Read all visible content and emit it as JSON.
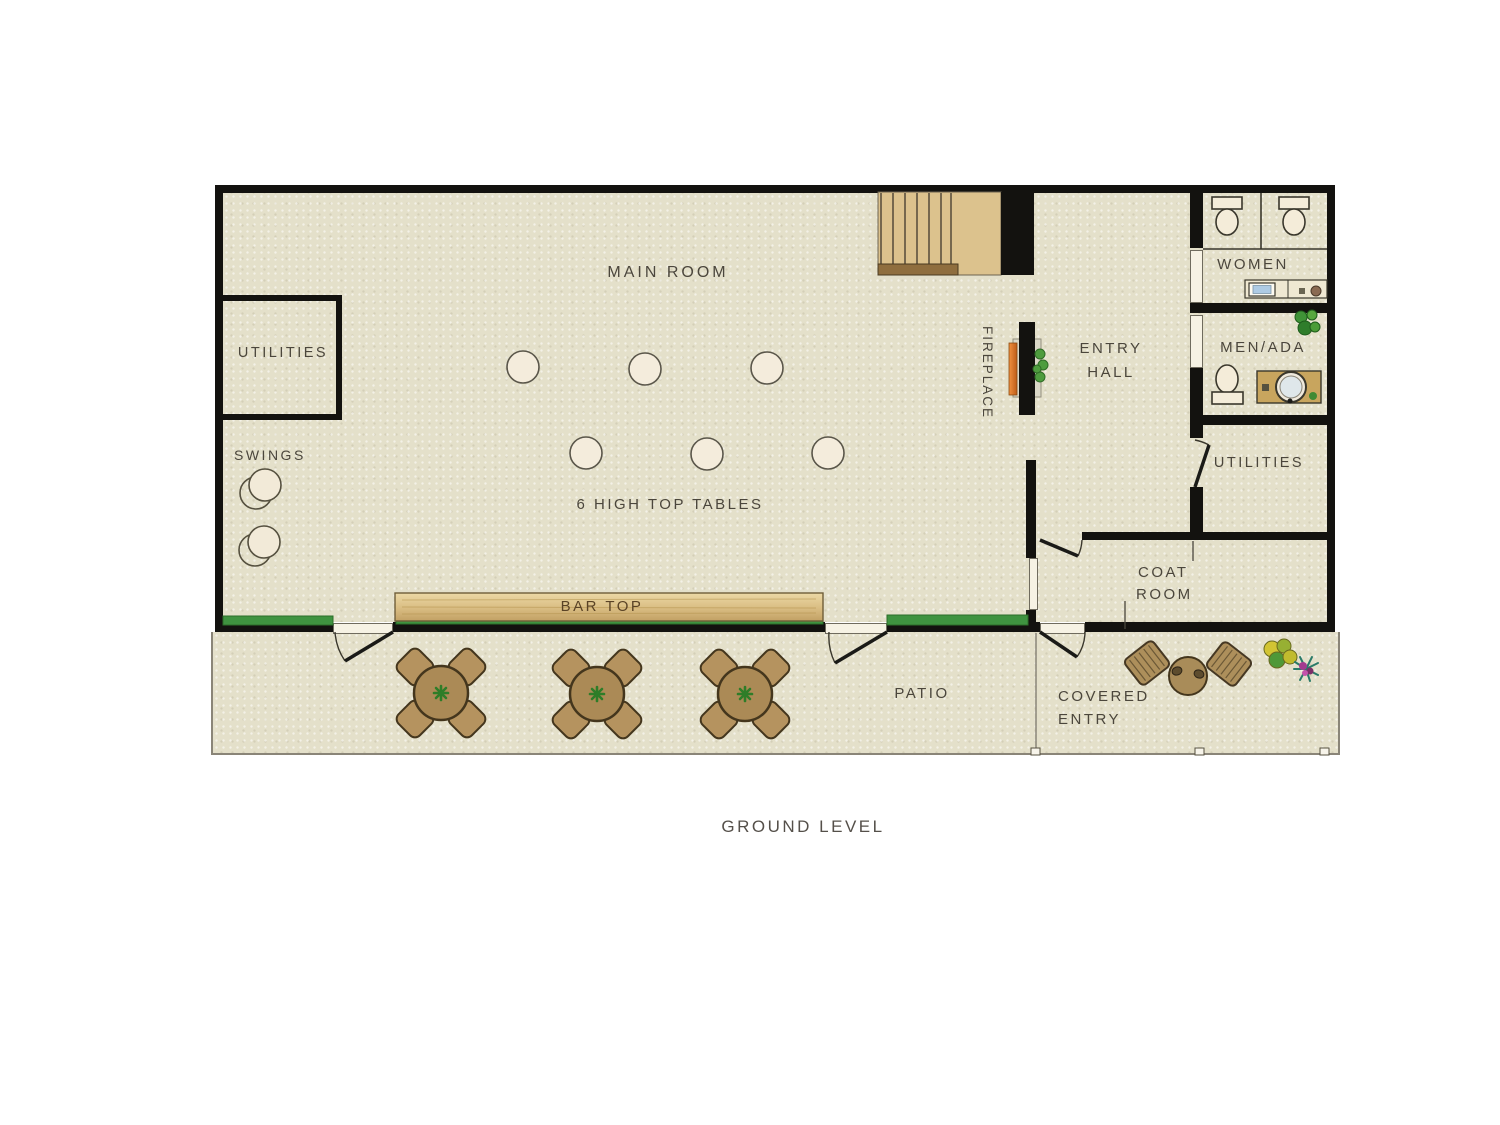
{
  "title": "GROUND LEVEL",
  "labels": {
    "main_room": "MAIN ROOM",
    "utilities_left": "UTILITIES",
    "swings": "SWINGS",
    "high_top_note": "6 HIGH TOP TABLES",
    "bar_top": "BAR TOP",
    "fireplace": "FIREPLACE",
    "entry_hall_line1": "ENTRY",
    "entry_hall_line2": "HALL",
    "women": "WOMEN",
    "men_ada": "MEN/ADA",
    "utilities_right": "UTILITIES",
    "coat_room_line1": "COAT",
    "coat_room_line2": "ROOM",
    "patio": "PATIO",
    "covered_entry_line1": "COVERED",
    "covered_entry_line2": "ENTRY"
  },
  "colors": {
    "floor": "#e4e0ca",
    "wall": "#13120f",
    "grass": "#3f9340",
    "bar_wood": "#d9bc82",
    "stair_wood": "#dcc28d",
    "table_brown": "#ab8a56",
    "fireplace_orange": "#e07a28",
    "sink_blue": "#aecbe4",
    "text": "#4b463c"
  }
}
